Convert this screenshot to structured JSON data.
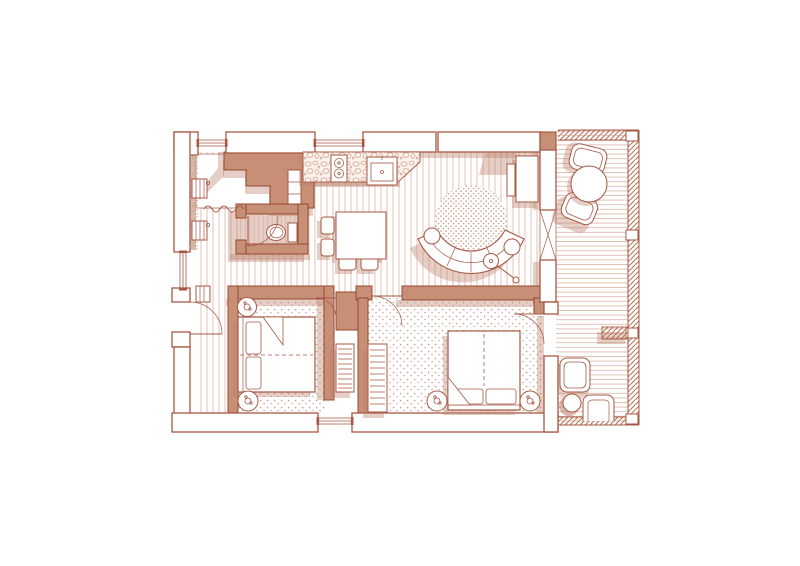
{
  "meta": {
    "title": "Apartment floor plan — sienna ink line drawing on white",
    "drawing_type": "architectural-floor-plan",
    "orientation": "plan view (top-down)"
  },
  "palette": {
    "background": "#ffffff",
    "ink": "#a65843",
    "ink_dark": "#97492f",
    "wall_fill": "#c88f77",
    "shadow": "#b97f68",
    "texture": "#dcb4a2",
    "texture_soft": "#ead0c3",
    "texture_dark": "#cfa08c",
    "railing": "#b5765c"
  },
  "rooms": [
    {
      "id": "entry-closet",
      "floor_pattern": "square-tile",
      "items": [
        "built-in-wardrobe",
        "radiator",
        "radiator",
        "curtain"
      ]
    },
    {
      "id": "bathroom",
      "floor_pattern": "narrow-boards",
      "items": [
        "toilet",
        "cistern",
        "door-swing"
      ]
    },
    {
      "id": "kitchen",
      "floor_pattern": "wood-boards",
      "items": [
        "stone-countertop",
        "two-burner-stove",
        "sink"
      ]
    },
    {
      "id": "living-dining",
      "floor_pattern": "wood-boards",
      "items": [
        "dining-table",
        "dining-chair",
        "dining-chair",
        "dining-chair",
        "dining-chair",
        "curved-sofa",
        "round-rug",
        "floor-lamp",
        "side-table",
        "side-table",
        "tv-console",
        "tv"
      ]
    },
    {
      "id": "hallway",
      "floor_pattern": "wood-boards",
      "items": [
        "entry-door-swing",
        "radiator"
      ]
    },
    {
      "id": "bedroom-1",
      "floor_pattern": "stipple-carpet",
      "items": [
        "double-bed",
        "pillow",
        "pillow",
        "round-nightstand",
        "round-nightstand",
        "slatted-radiator"
      ]
    },
    {
      "id": "bedroom-2",
      "floor_pattern": "stipple-carpet",
      "items": [
        "double-bed",
        "pillow",
        "pillow",
        "round-nightstand",
        "round-nightstand",
        "slatted-wardrobe",
        "door-swing",
        "balcony-door-swing"
      ]
    },
    {
      "id": "balcony",
      "floor_pattern": "deck-boards",
      "items": [
        "bistro-table",
        "bistro-chair",
        "bistro-chair",
        "lounge-chair",
        "lounge-chair",
        "side-table",
        "hatched-railing",
        "railing-post",
        "railing-post",
        "railing-post",
        "railing-post",
        "privacy-divider"
      ]
    }
  ],
  "openings": {
    "window_count": 4,
    "door_swings": 5,
    "sliding_door_marker": "bowtie-x between living room and balcony"
  }
}
